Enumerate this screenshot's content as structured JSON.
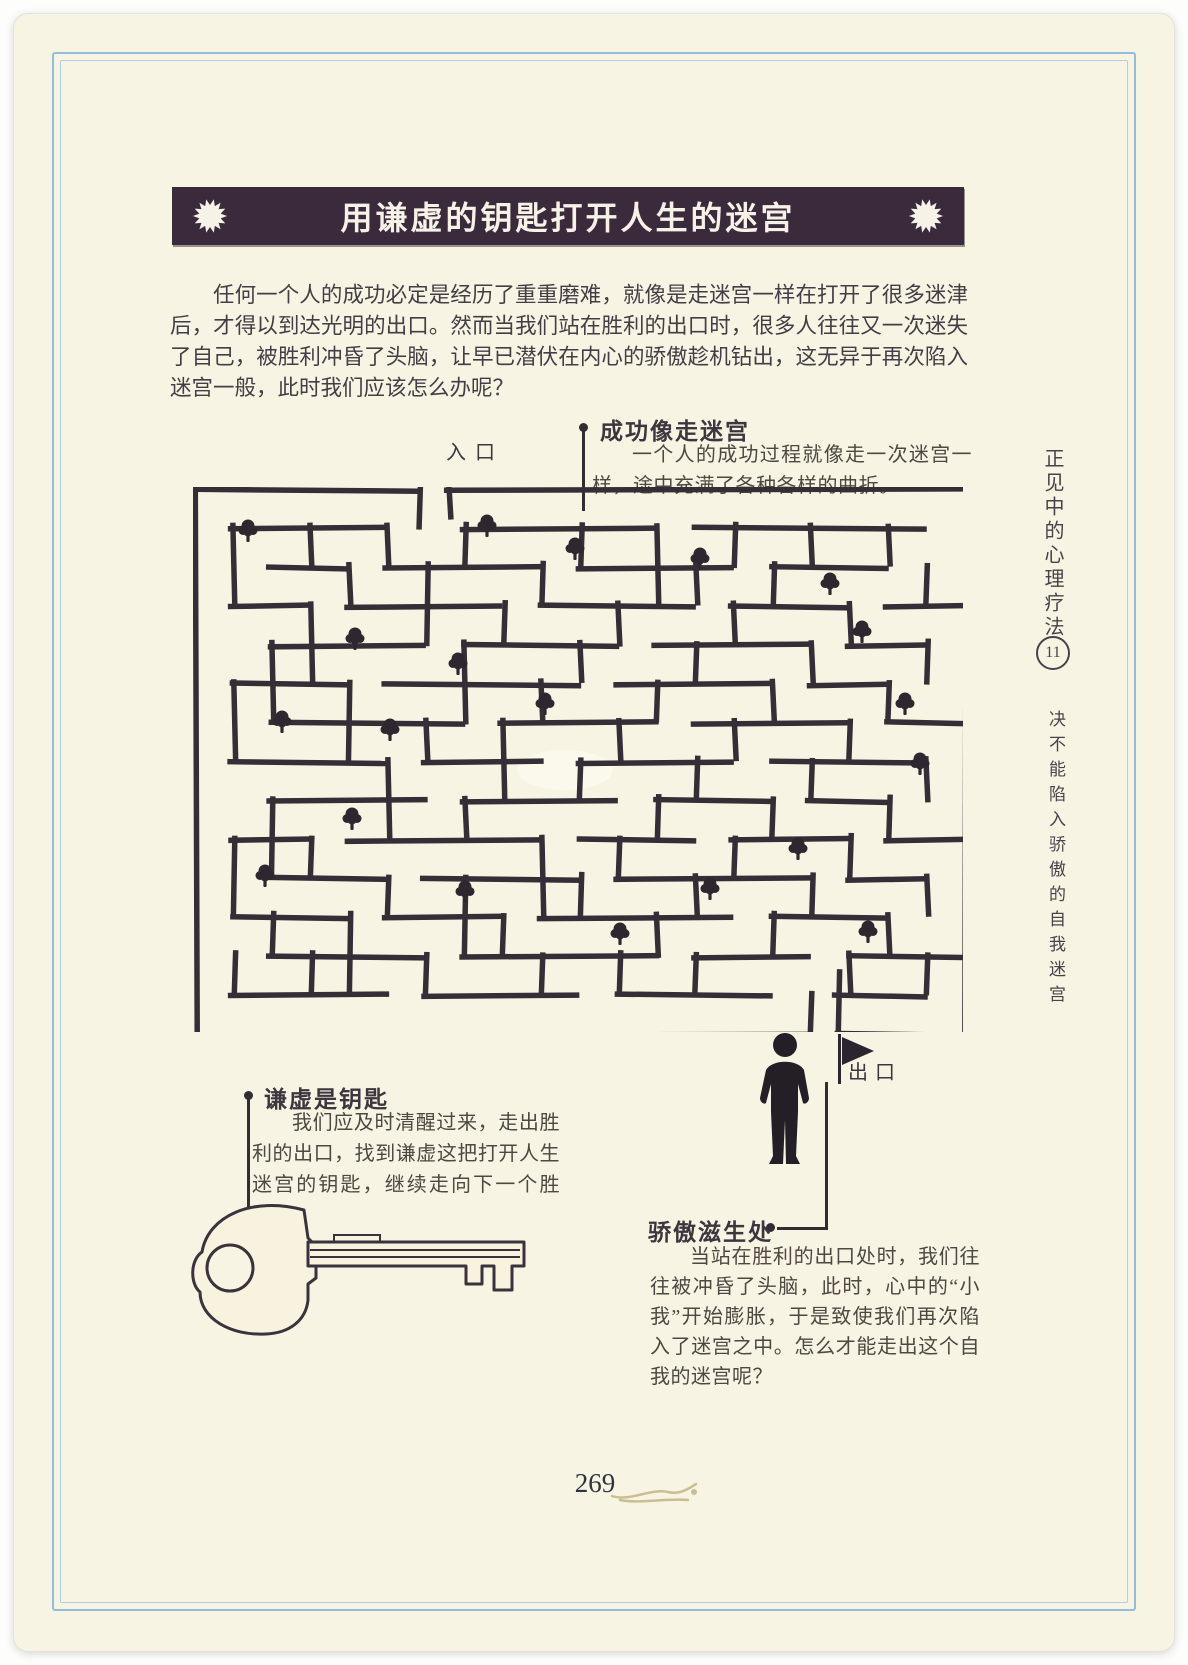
{
  "page": {
    "title": "用谦虚的钥匙打开人生的迷宫",
    "page_number": "269"
  },
  "intro": {
    "text": "任何一个人的成功必定是经历了重重磨难，就像是走迷宫一样在打开了很多迷津后，才得以到达光明的出口。然而当我们站在胜利的出口时，很多人往往又一次迷失了自己，被胜利冲昏了头脑，让早已潜伏在内心的骄傲趁机钻出，这无异于再次陷入迷宫一般，此时我们应该怎么办呢？"
  },
  "maze": {
    "entrance_label": "入口",
    "exit_label": "出口"
  },
  "callouts": {
    "success": {
      "heading": "成功像走迷宫",
      "body": "一个人的成功过程就像走一次迷宫一样，途中充满了各种各样的曲折。"
    },
    "humility": {
      "heading": "谦虚是钥匙",
      "body": "我们应及时清醒过来，走出胜利的出口，找到谦虚这把打开人生迷宫的钥匙，继续走向下一个胜利。"
    },
    "pride": {
      "heading": "骄傲滋生处",
      "body": "当站在胜利的出口处时，我们往往被冲昏了头脑，此时，心中的“小我”开始膨胀，于是致使我们再次陷入了迷宫之中。怎么才能走出这个自我的迷宫呢？"
    }
  },
  "sidebar": {
    "book_title": "正见中的心理疗法",
    "chapter_number": "11",
    "chapter_title": "决不能陷入骄傲的自我迷宫"
  },
  "colors": {
    "paper": "#f8f4e3",
    "ink": "#453d46",
    "banner_bg": "#3a2a3c",
    "frame_blue": "#92bedb",
    "maze_wall": "#362e37"
  }
}
